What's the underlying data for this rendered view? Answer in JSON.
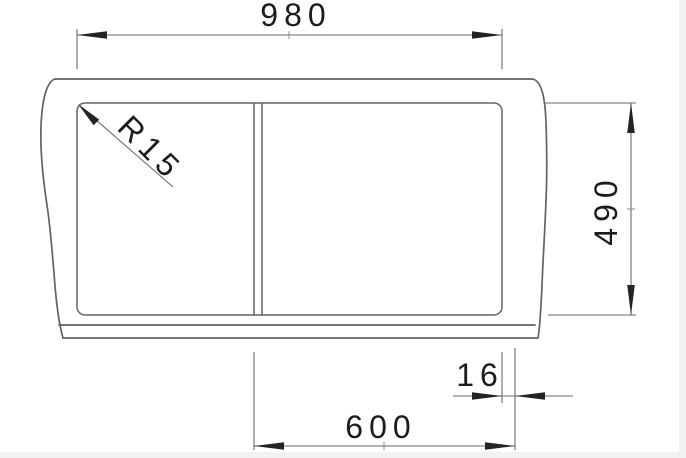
{
  "drawing": {
    "type": "sink-installation-dimension-drawing",
    "labels": {
      "overall_width": "980",
      "overall_depth": "490",
      "corner_radius": "R15",
      "edge_offset": "16",
      "cabinet_width": "600"
    },
    "colors": {
      "outline": "#636363",
      "dimension_line": "#6a6a6a",
      "text_and_arrows": "#1c1c1c",
      "background": "#ffffff",
      "page_edge": "#f2f2f4"
    }
  }
}
